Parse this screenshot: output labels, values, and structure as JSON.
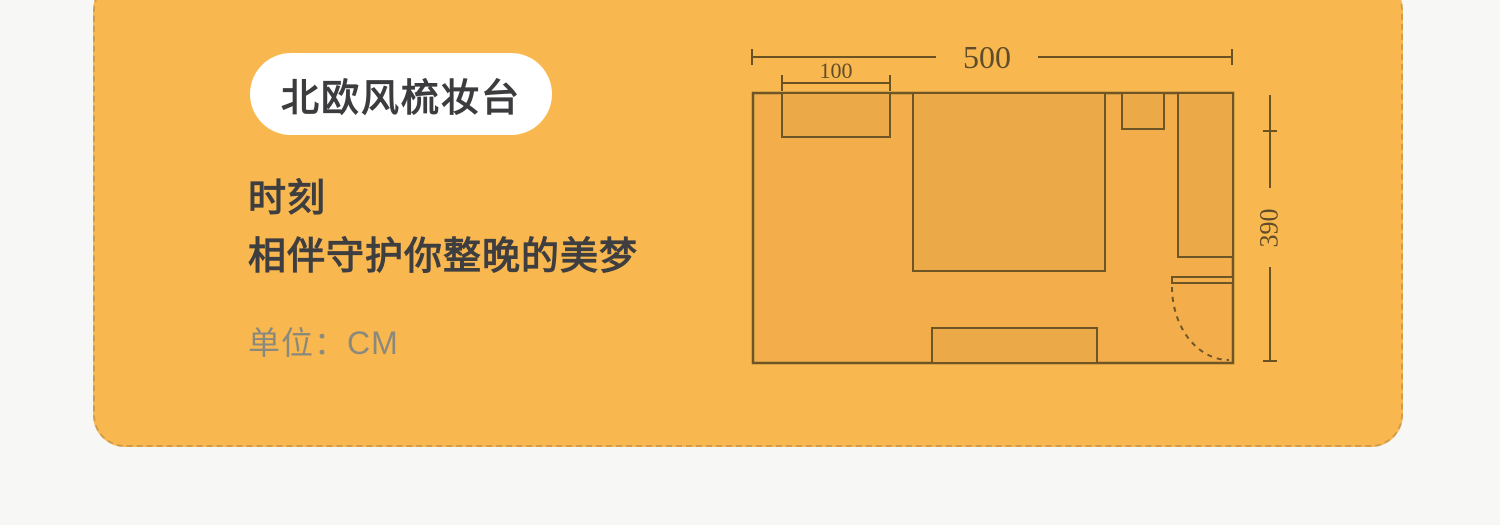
{
  "page": {
    "background_color": "#f7f7f5"
  },
  "card": {
    "background_color": "#f9b84f",
    "border_color": "#cf9c49"
  },
  "badge": {
    "label": "北欧风梳妆台"
  },
  "tagline": {
    "line1": "时刻",
    "line2": "相伴守护你整晚的美梦"
  },
  "unit_note": {
    "text": "单位：CM"
  },
  "floor_plan": {
    "type": "room-floor-plan",
    "unit": "CM",
    "overall_width_label": "500",
    "dresser_width_label": "100",
    "overall_depth_label": "390",
    "measurements": {
      "room_width_cm": 500,
      "room_depth_cm": 390,
      "dressing_table_width_cm": 100
    },
    "colors": {
      "floor_fill": "#f3ae4b",
      "furniture_fill": "#eba948",
      "line_color": "#6d5526",
      "dimension_text_color": "#5f4c28"
    }
  }
}
